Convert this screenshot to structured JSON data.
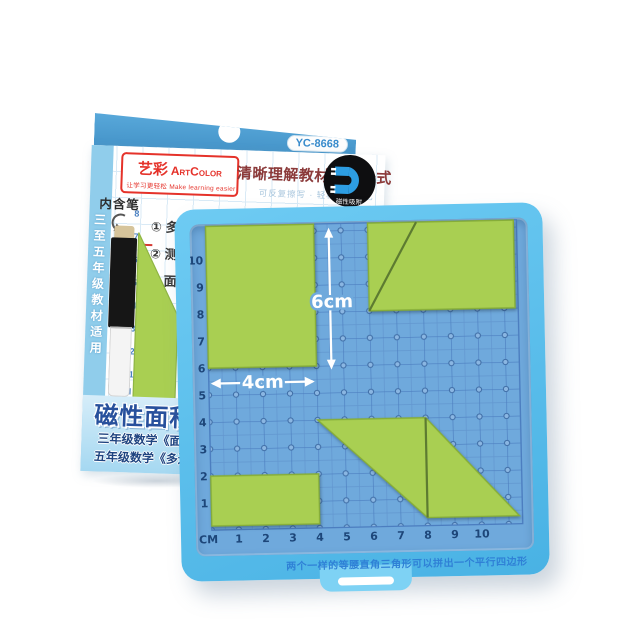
{
  "package": {
    "model": "YC-8668",
    "brand": {
      "cn": "艺彩",
      "en": "ArtColor",
      "reg": "®",
      "tagline": "让学习更轻松  Make learning easier"
    },
    "title": "清晰理解教材面积公式",
    "subtitle": "可反复擦写 · 轻松理解记忆",
    "magnet_badge": "磁性吸附",
    "side_text": "三至五年级教材适用",
    "pen_label": "内含笔",
    "steps": [
      "① 多",
      "② 测",
      "③ 面"
    ],
    "example_label": "例:",
    "example_dim": "4",
    "face_axis_y": [
      "8",
      "7",
      "6",
      "5",
      "4",
      "3",
      "2",
      "1"
    ],
    "face_axis_x": [
      "CM",
      "1"
    ],
    "series_title": "磁性面积",
    "grade_line1": "三年级数学《面积",
    "grade_line2": "五年级数学《多边"
  },
  "board": {
    "unit_label": "CM",
    "x_labels": [
      "1",
      "2",
      "3",
      "4",
      "5",
      "6",
      "7",
      "8",
      "9",
      "10"
    ],
    "y_labels": [
      "1",
      "2",
      "3",
      "4",
      "5",
      "6",
      "7",
      "8",
      "9",
      "10"
    ],
    "width_label": "4cm",
    "height_label": "6cm",
    "caption": "两个一样的等腰直角三角形可以拼出一个平行四边形",
    "shapes": [
      {
        "name": "rectangle-4x6",
        "points": [
          [
            0,
            6
          ],
          [
            4,
            6
          ],
          [
            4,
            11.25
          ],
          [
            0,
            11.25
          ]
        ]
      },
      {
        "name": "split-rectangle",
        "points": [
          [
            6,
            8
          ],
          [
            11.4,
            8
          ],
          [
            11.4,
            11.25
          ],
          [
            6,
            11.25
          ]
        ],
        "split": [
          [
            6,
            8
          ],
          [
            7.8,
            11.25
          ]
        ]
      },
      {
        "name": "small-rectangle",
        "points": [
          [
            0,
            0.15
          ],
          [
            4,
            0.15
          ],
          [
            4,
            2
          ],
          [
            0,
            2
          ]
        ]
      },
      {
        "name": "parallelogram",
        "points": [
          [
            4,
            4
          ],
          [
            8,
            4
          ],
          [
            11.4,
            0.3
          ],
          [
            8,
            0.3
          ]
        ],
        "split": [
          [
            8,
            4
          ],
          [
            8,
            0.3
          ]
        ]
      }
    ],
    "colors": {
      "panel": "#6fa9dc",
      "grid_line": "#4c7ec0",
      "piece": "#a9cf52",
      "frame": "#57c0ee"
    }
  }
}
